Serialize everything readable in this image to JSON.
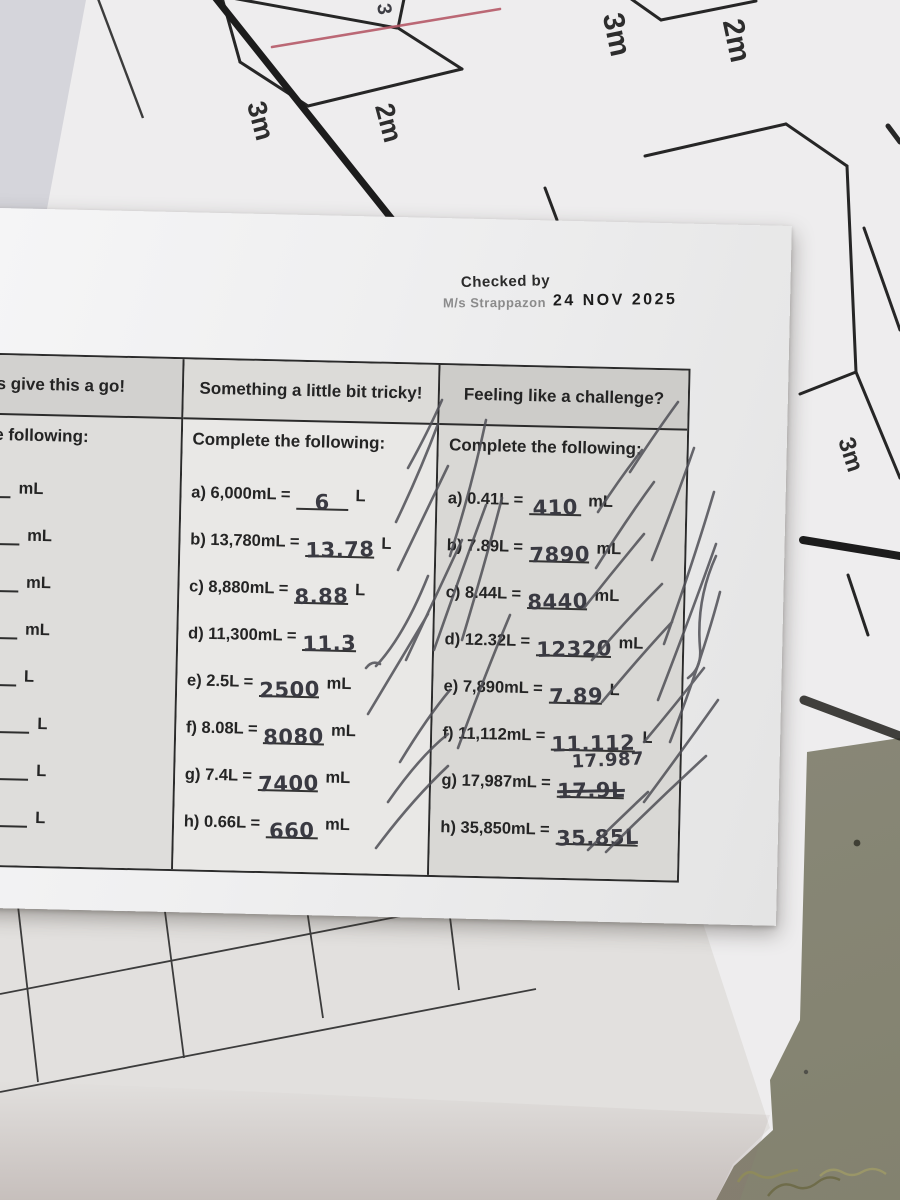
{
  "stamp": {
    "checked_by": "Checked by",
    "signature": "M/s Strappazon",
    "date": "24 NOV 2025"
  },
  "worksheet_table": {
    "headers": [
      "s give this a go!",
      "Something a little bit tricky!",
      "Feeling like a challenge?"
    ],
    "columns": [
      {
        "title": "ete the following:",
        "items": [
          {
            "pre": "",
            "post": "mL"
          },
          {
            "pre": "=",
            "post": "mL"
          },
          {
            "pre": "=",
            "post": "mL"
          },
          {
            "pre": "=",
            "post": "mL"
          },
          {
            "pre": "=",
            "post": "L"
          },
          {
            "pre": "L =",
            "post": "L"
          },
          {
            "pre": "L =",
            "post": "L"
          },
          {
            "pre": "L =",
            "post": "L"
          }
        ]
      },
      {
        "title": "Complete the following:",
        "items": [
          {
            "pre": "a) 6,000mL =",
            "ans": "6",
            "post": "L"
          },
          {
            "pre": "b) 13,780mL =",
            "ans": "13.78",
            "post": "L"
          },
          {
            "pre": "c) 8,880mL =",
            "ans": "8.88",
            "post": "L"
          },
          {
            "pre": "d) 11,300mL =",
            "ans": "11.3",
            "post": ""
          },
          {
            "pre": "e) 2.5L =",
            "ans": "2500",
            "post": "mL"
          },
          {
            "pre": "f) 8.08L =",
            "ans": "8080",
            "post": "mL"
          },
          {
            "pre": "g) 7.4L =",
            "ans": "7400",
            "post": "mL"
          },
          {
            "pre": "h) 0.66L =",
            "ans": "660",
            "post": "mL"
          }
        ]
      },
      {
        "title": "Complete the following:",
        "items": [
          {
            "pre": "a) 0.41L =",
            "ans": "410",
            "post": "mL"
          },
          {
            "pre": "b) 7.89L =",
            "ans": "7890",
            "post": "mL"
          },
          {
            "pre": "c) 8.44L =",
            "ans": "8440",
            "post": "mL"
          },
          {
            "pre": "d) 12.32L =",
            "ans": "12320",
            "post": "mL"
          },
          {
            "pre": "e) 7,890mL =",
            "ans": "7.89",
            "post": "L"
          },
          {
            "pre": "f) 11,112mL =",
            "ans": "11.112",
            "post": "L"
          },
          {
            "pre": "g) 17,987mL =",
            "ans": "17.9L",
            "correction": "17.987",
            "post": ""
          },
          {
            "pre": "h) 35,850mL =",
            "ans": "35.85L",
            "post": ""
          }
        ]
      }
    ]
  },
  "background": {
    "dimension_labels": [
      {
        "text": "3m"
      },
      {
        "text": "2m"
      },
      {
        "text": "3m"
      },
      {
        "text": "2m"
      },
      {
        "text": "3m"
      }
    ],
    "handwritten_note": "3"
  },
  "colors": {
    "desk": "#8c8b7d",
    "paper": "#eeedee",
    "pencil": "#4a4a50",
    "red_pen": "#b65a68",
    "table_border": "#2b2b2b"
  }
}
